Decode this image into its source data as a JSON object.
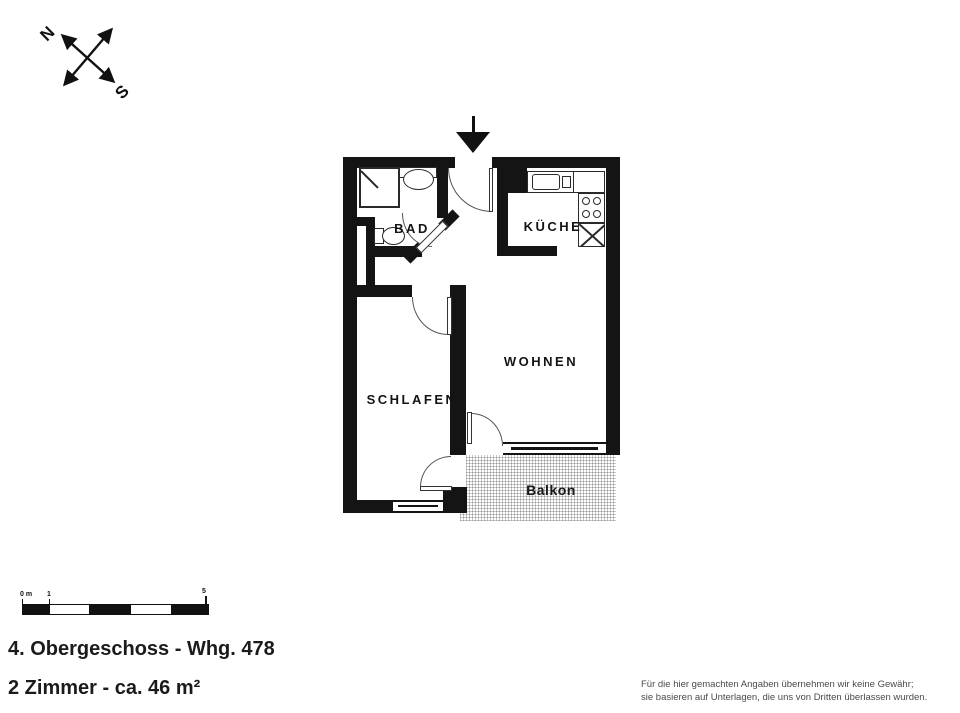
{
  "compass": {
    "north": "N",
    "south": "S"
  },
  "floorplan": {
    "rooms": {
      "bad": {
        "label": "BAD"
      },
      "kueche": {
        "label": "KÜCHE"
      },
      "wohnen": {
        "label": "WOHNEN"
      },
      "schlafen": {
        "label": "SCHLAFEN"
      },
      "balkon": {
        "label": "Balkon"
      }
    },
    "fixtures": [
      "shower",
      "washbasin",
      "wc",
      "kitchen-sink",
      "stove",
      "refrigerator"
    ],
    "colors": {
      "wall": "#141414",
      "fixture_line": "#2a2a2a",
      "balcony_hatch": "#c7c7c7"
    }
  },
  "scalebar": {
    "labels": [
      {
        "text": "0 m"
      },
      {
        "text": "1"
      },
      {
        "text": "5"
      }
    ]
  },
  "info": {
    "floor_line": "4. Obergeschoss - Whg. 478",
    "rooms_line": "2 Zimmer - ca. 46 m²"
  },
  "disclaimer": {
    "line1": "Für die hier gemachten Angaben übernehmen wir keine Gewähr;",
    "line2": "sie basieren auf Unterlagen, die uns von Dritten überlassen wurden."
  }
}
